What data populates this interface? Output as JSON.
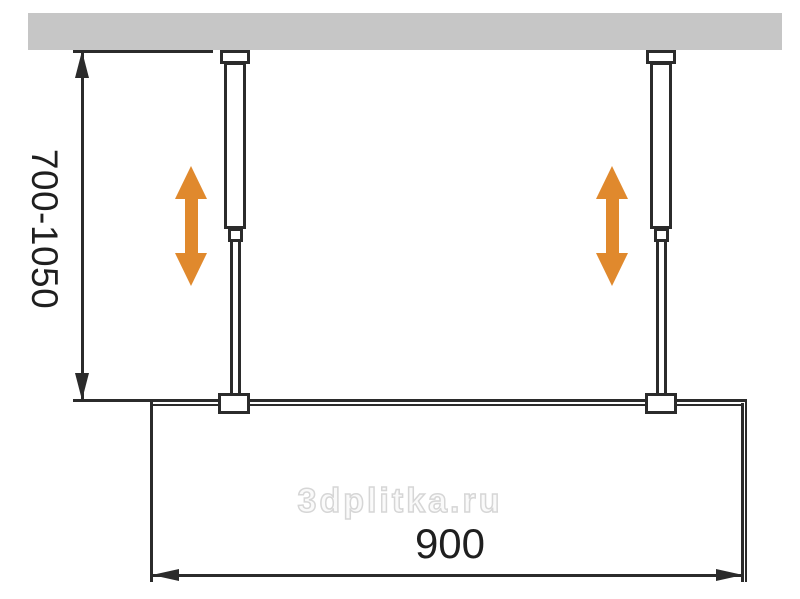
{
  "colors": {
    "accent_orange": "#E0892D",
    "ceiling_gray": "#C6C6C6",
    "line_dark": "#2B2B2B",
    "text_dark": "#1F1F1F",
    "watermark_gray": "#D6D6D6"
  },
  "dimensions": {
    "height_range": {
      "label": "700-1050"
    },
    "width": {
      "label": "900"
    }
  },
  "icons": {
    "left_adjust_arrow": "double-vertical-arrow",
    "right_adjust_arrow": "double-vertical-arrow"
  },
  "watermark": {
    "text": "3dplitka.ru"
  }
}
